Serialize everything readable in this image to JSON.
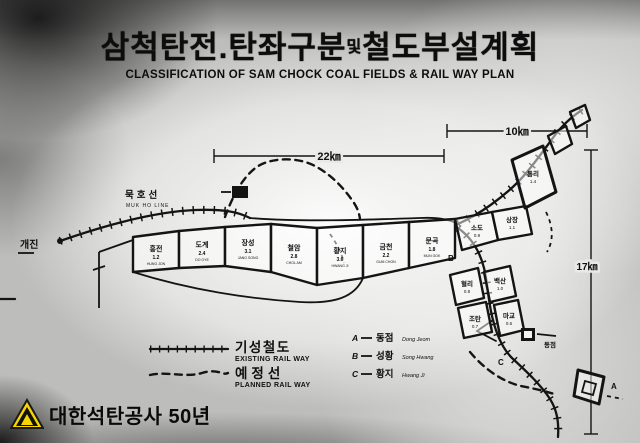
{
  "title": {
    "korean_left": "삼척탄전.탄좌구분",
    "korean_small": "및",
    "korean_right": "철도부설계획",
    "english": "CLASSIFICATION OF SAM CHOCK COAL FIELDS & RAIL WAY PLAN"
  },
  "dimensions": {
    "belt_width": "22㎞",
    "right_width": "10㎞",
    "right_height": "17㎞"
  },
  "rail_labels": {
    "line_korean": "묵호선",
    "line_english": "MUK HO LINE",
    "left_station": "개진",
    "station_east": "동점"
  },
  "legend": {
    "existing_korean": "기성철도",
    "existing_english": "EXISTING RAIL WAY",
    "planned_korean": "예정선",
    "planned_english": "PLANNED RAIL WAY",
    "markers": [
      {
        "letter": "A",
        "korean": "동점",
        "roman": "Dong Jeom"
      },
      {
        "letter": "B",
        "korean": "성황",
        "roman": "Song Hwang"
      },
      {
        "letter": "C",
        "korean": "황지",
        "roman": "Hwang Ji"
      }
    ]
  },
  "map": {
    "belt_blocks": [
      {
        "name": "흥전",
        "num": "1.2",
        "roman": "HUNG JON"
      },
      {
        "name": "도계",
        "num": "2.4",
        "roman": "DO GYE"
      },
      {
        "name": "장성",
        "num": "3.1",
        "roman": "JANG SONG"
      },
      {
        "name": "철암",
        "num": "2.8",
        "roman": "CHOL AM"
      },
      {
        "name": "황지",
        "num": "3.6",
        "roman": "HWANG JI"
      },
      {
        "name": "금천",
        "num": "2.2",
        "roman": "GUM CHON"
      },
      {
        "name": "문곡",
        "num": "1.8",
        "roman": "MUN GOK"
      }
    ],
    "cluster_blocks": [
      {
        "name": "소도",
        "num": "0.9"
      },
      {
        "name": "상장",
        "num": "1.1"
      },
      {
        "name": "통리",
        "num": "1.4"
      },
      {
        "name": "혈리",
        "num": "0.8"
      },
      {
        "name": "백산",
        "num": "1.0"
      },
      {
        "name": "조탄",
        "num": "0.7"
      },
      {
        "name": "마교",
        "num": "0.6"
      }
    ],
    "point_letters": {
      "a": "A",
      "b": "B",
      "c": "C"
    }
  },
  "watermark": {
    "text": "대한석탄공사 50년",
    "logo_color": "#f6d500"
  }
}
